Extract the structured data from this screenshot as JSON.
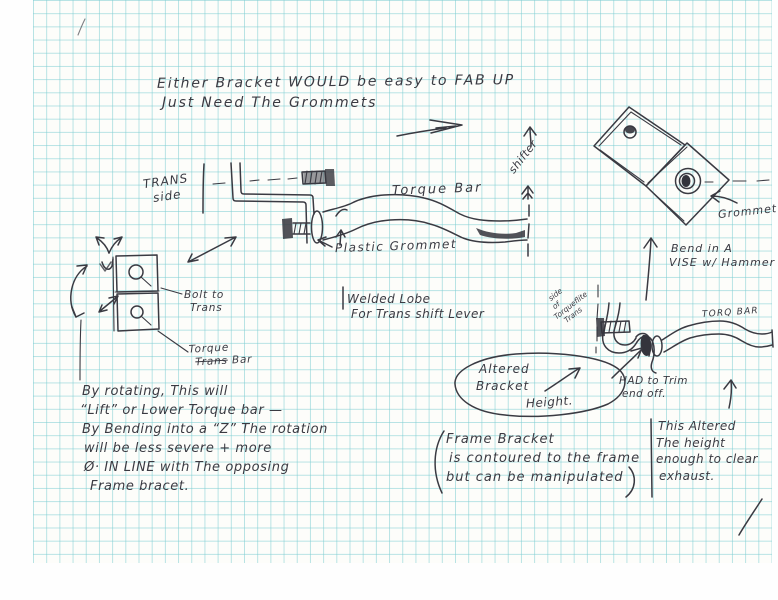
{
  "colors": {
    "paper": "#fdfdfa",
    "grid": "#7dcdd2",
    "ink": "#3a3a42"
  },
  "notes": {
    "header": {
      "l1": "Either Bracket WOULD be easy to FAB UP",
      "l2": "Just Need The Grommets"
    },
    "trans_side": {
      "l1": "TRANS",
      "l2": "side"
    },
    "torque_bar_label": "Torque Bar",
    "plastic_grommet": "Plastic Grommet",
    "shifter": "shifter",
    "grommet": "Grommet",
    "bend_vise": {
      "l1": "Bend in A",
      "l2": "VISE w/ Hammer"
    },
    "bolt_to_trans": {
      "l1": "Bolt to",
      "l2": "Trans"
    },
    "torque_trans_bar": {
      "l1": "Torque",
      "struck": "Trans",
      "rest": "Bar"
    },
    "rotating": {
      "l1": "By rotating, This will",
      "l2": "“Lift” or Lower Torque bar —",
      "l3": "By Bending into a “Z” The rotation",
      "l4": "will be less severe + more",
      "l5": "Ø· IN LINE with The opposing",
      "l6": "Frame bracet."
    },
    "welded_lobe": {
      "l1": "Welded Lobe",
      "l2": "For Trans shift Lever"
    },
    "altered_oval": {
      "l1": "Altered",
      "l2": "Bracket",
      "l3": "Height."
    },
    "frame_note": {
      "open": "(",
      "l1": "Frame Bracket",
      "l2": "is contoured to the frame",
      "l3": "but can be manipulated",
      "close": ")"
    },
    "side_of": {
      "l1": "side",
      "l2": "of",
      "l3": "Torqueflite",
      "l4": "Trans"
    },
    "torq_bar": "TORQ BAR",
    "trim": {
      "l1": "HAD to Trim",
      "l2": "end off."
    },
    "altered_right": {
      "l1": "This Altered",
      "l2": "The height",
      "l3": "enough to clear",
      "l4": "exhaust."
    }
  }
}
